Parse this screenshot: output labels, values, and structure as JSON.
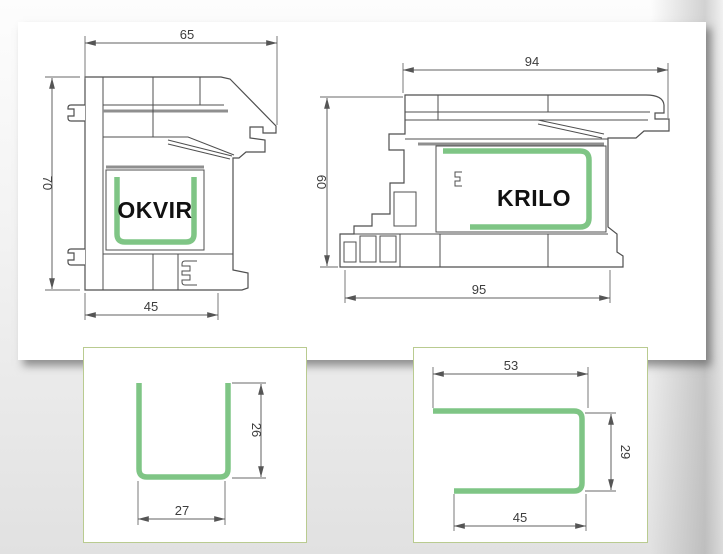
{
  "figure": {
    "type": "window-profile-cross-sections",
    "profiles": [
      {
        "id": "okvir",
        "label": "OKVIR",
        "dimensions": {
          "top_width": "65",
          "height": "70",
          "bottom_width": "45"
        }
      },
      {
        "id": "krilo",
        "label": "KRILO",
        "dimensions": {
          "top_width": "94",
          "height": "60",
          "bottom_width": "95"
        }
      }
    ],
    "reinforcement_details": [
      {
        "id": "u-channel",
        "shape": "U",
        "dimensions": {
          "height": "26",
          "width": "27"
        }
      },
      {
        "id": "c-channel",
        "shape": "C",
        "dimensions": {
          "top_width": "53",
          "height": "29",
          "bottom_width": "45"
        }
      }
    ],
    "colors": {
      "reinforcement_green": "#7fc585",
      "detail_box_border": "#b9cb90",
      "drawing_line": "#4f4f4f",
      "dimension_line": "#606060"
    }
  }
}
